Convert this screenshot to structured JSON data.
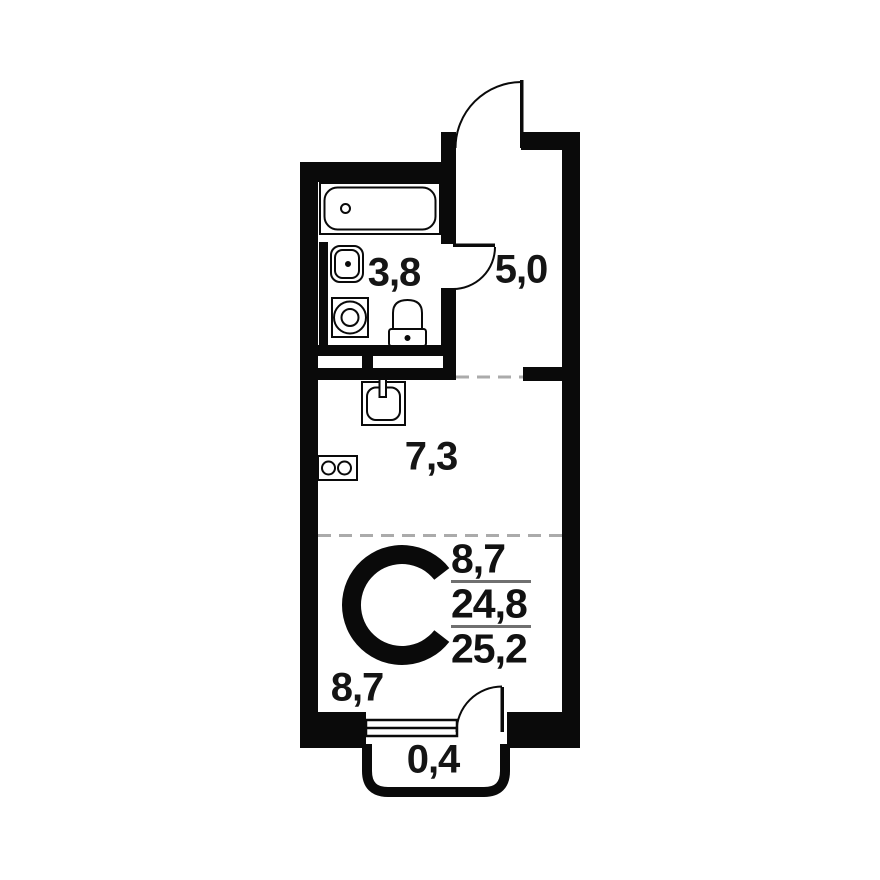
{
  "floorplan": {
    "unit_type_letter": "C",
    "rooms": {
      "bathroom": {
        "area_label": "3,8"
      },
      "hallway": {
        "area_label": "5,0"
      },
      "kitchen": {
        "area_label": "7,3"
      },
      "living_room": {
        "area_label": "8,7"
      },
      "balcony": {
        "area_label": "0,4"
      }
    },
    "area_summary": {
      "living_area": "8,7",
      "floor_area": "24,8",
      "total_area": "25,2"
    },
    "fixtures": [
      "bathtub-icon",
      "washbasin-icon",
      "washing-machine-icon",
      "toilet-icon",
      "kitchen-sink-icon",
      "stove-icon",
      "entry-door-icon",
      "bathroom-door-icon",
      "balcony-door-icon",
      "window-icon",
      "vent-shaft-icon"
    ],
    "colors": {
      "walls": "#0a0a0a",
      "dashed_zone_line": "#ababab",
      "summary_divider": "#707070",
      "text": "#151515",
      "background": "#ffffff"
    }
  }
}
